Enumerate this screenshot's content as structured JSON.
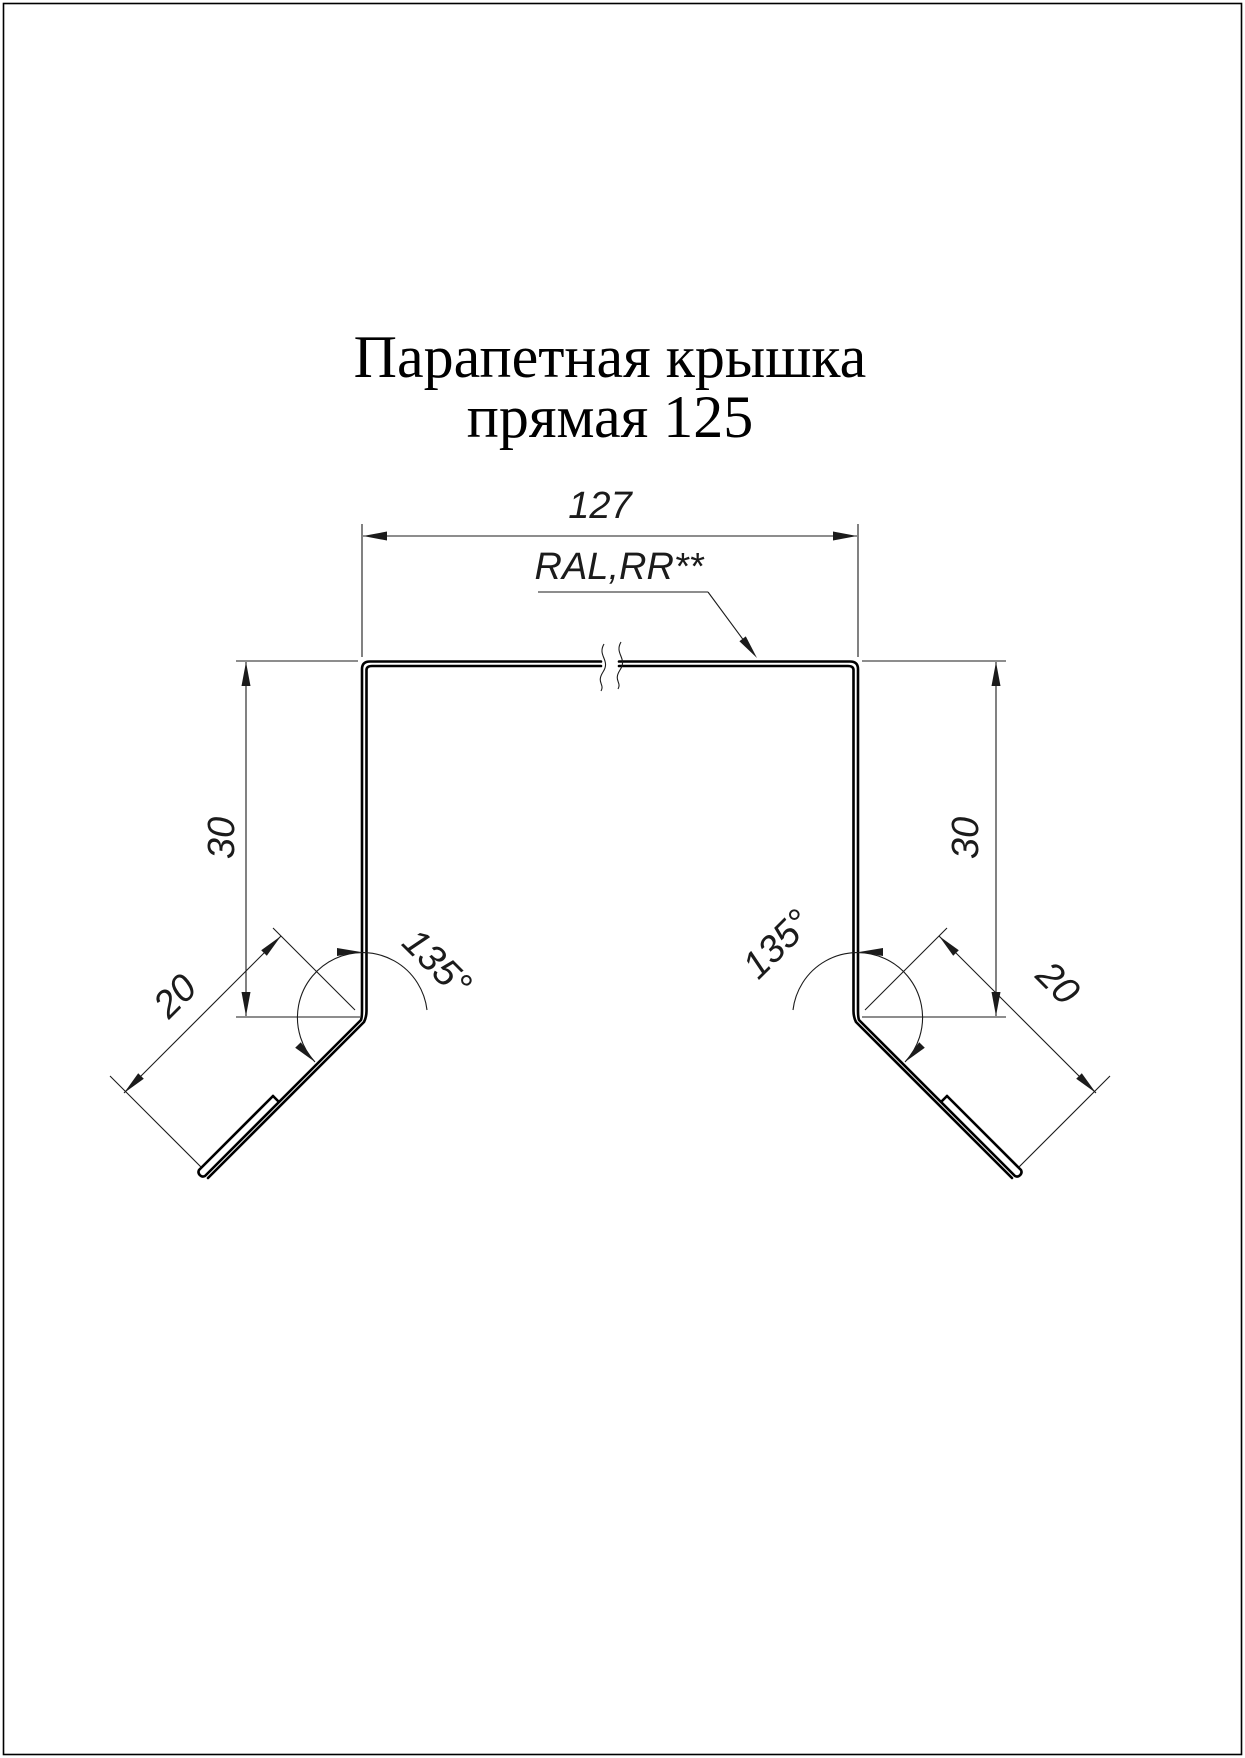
{
  "title": {
    "line1": "Парапетная крышка",
    "line2": "прямая 125"
  },
  "labels": {
    "top_width": "127",
    "coating": "RAL,RR**",
    "left_height": "30",
    "right_height": "30",
    "left_hem": "20",
    "right_hem": "20",
    "left_angle": "135°",
    "right_angle": "135°"
  },
  "colors": {
    "line": "#1b1b1b",
    "profile": "#000000",
    "background": "#ffffff"
  }
}
